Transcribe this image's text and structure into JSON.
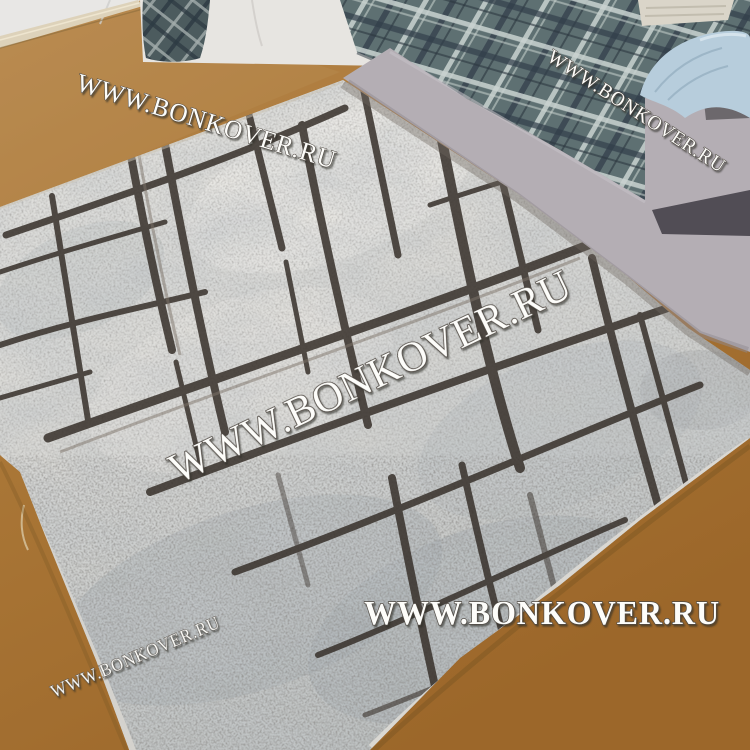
{
  "watermark": {
    "text": "WWW.BONKOVER.RU",
    "fill": "#fdfdfa",
    "outline": "#4e4842"
  },
  "watermarks": [
    {
      "position": "top-left"
    },
    {
      "position": "top-right"
    },
    {
      "position": "center"
    },
    {
      "position": "bottom-left"
    },
    {
      "position": "bottom-center"
    }
  ],
  "colors": {
    "floor_top": "#b8894e",
    "floor_mid": "#aa7737",
    "floor_bottom": "#9c672a",
    "wall": "#e8e7e5",
    "baseboard": "#ddd2ba",
    "mattress_white": "#e7e5e1",
    "plaid_base": "#5e7072",
    "plaid_light": "#c9d2d0",
    "plaid_dark": "#323f4a",
    "sofa_gray": "#b4aeb4",
    "armrest_shadow": "#46424a",
    "pillow": "#b7cddc",
    "blanket": "#dad5c9",
    "rug_light": "#e6e5e1",
    "rug_mid": "#d7d7d4",
    "rug_dark_edge": "#b9bdbd",
    "rug_line": "#37302a",
    "rug_binding": "#d6d4cf"
  }
}
